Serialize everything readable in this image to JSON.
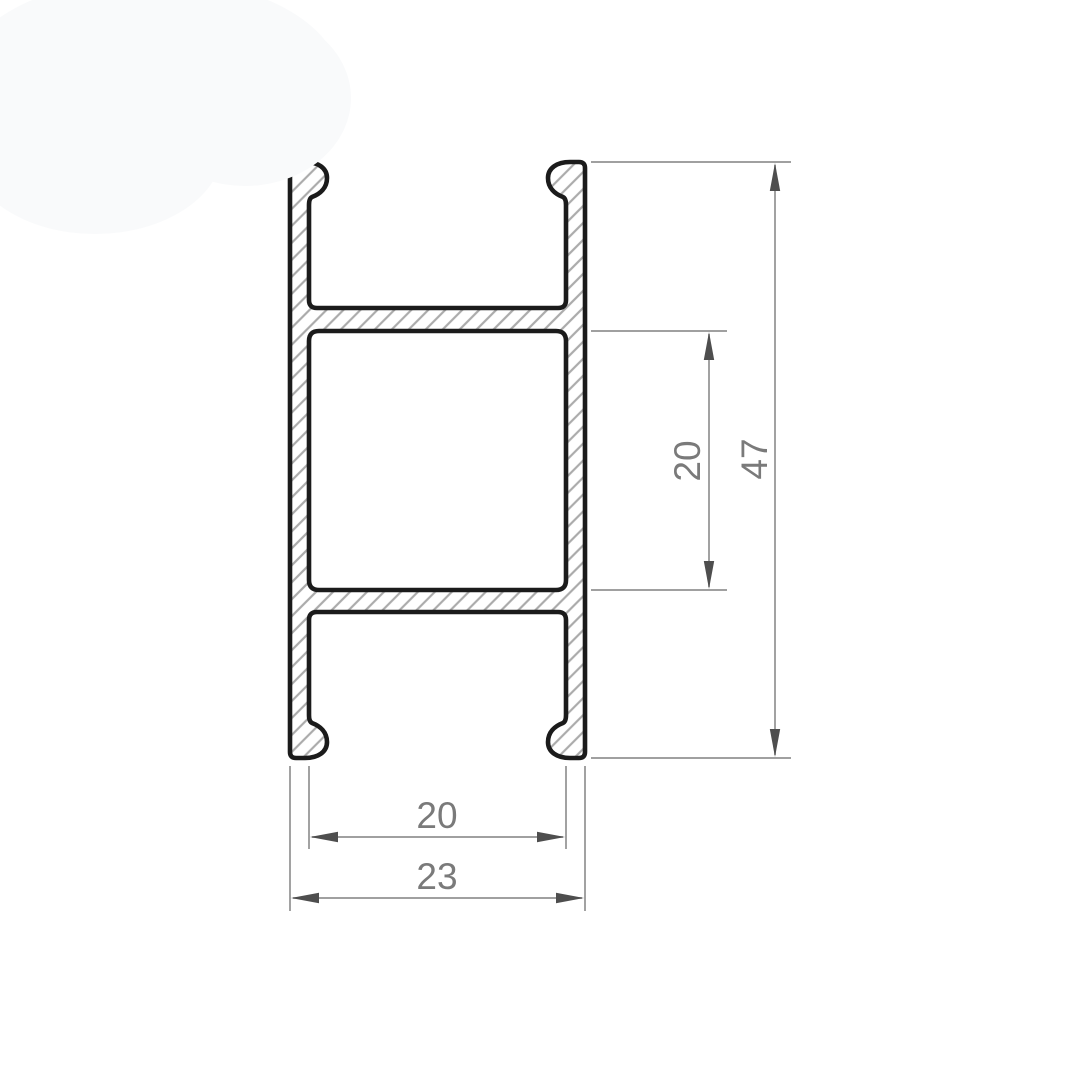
{
  "drawing": {
    "kind": "profile-cross-section-technical-drawing",
    "dimensions": {
      "inner_width": "20",
      "outer_width": "23",
      "inner_height": "20",
      "outer_height": "47"
    },
    "colors": {
      "outline": "#1b1b1b",
      "hatch": "#ababab",
      "dim_line": "#929292",
      "arrow": "#4e4e4e",
      "dim_text": "#7a7a7a",
      "background": "#ffffff",
      "watermark_blob": "#f9fafb"
    }
  }
}
